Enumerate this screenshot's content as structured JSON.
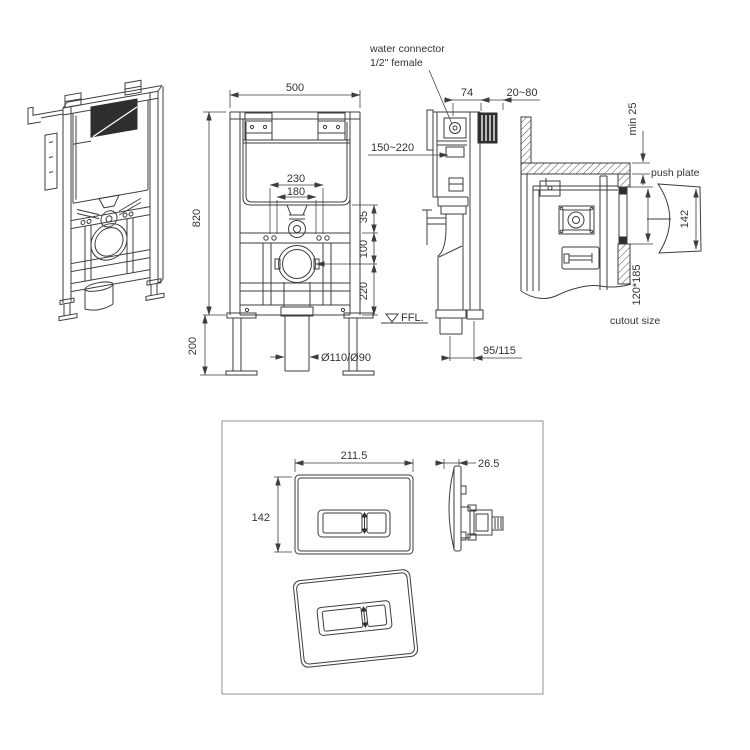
{
  "page": {
    "background": "#ffffff",
    "ink": "#3d3d3d",
    "box_border": "#909090"
  },
  "views": {
    "front": {
      "dim_width": "500",
      "dim_height": "820",
      "dim_leg": "200",
      "dim_bolt_outer": "230",
      "dim_bolt_inner": "180",
      "dim_35": "35",
      "dim_100": "100",
      "dim_220": "220",
      "dim_drain": "Ø110/Ø90",
      "ffl": "FFL."
    },
    "side": {
      "connector_label_1": "water connector",
      "connector_label_2": "1/2\" female",
      "dim_74": "74",
      "dim_depth": "20~80",
      "dim_height_range": "150~220",
      "dim_outlet": "95/115"
    },
    "wall": {
      "dim_cover": "min 25",
      "label_push_plate": "push plate",
      "dim_plate_height": "142",
      "dim_cutout": "120*185",
      "label_cutout": "cutout size"
    },
    "plate": {
      "dim_width": "211.5",
      "dim_height": "142",
      "dim_depth": "26.5"
    }
  }
}
